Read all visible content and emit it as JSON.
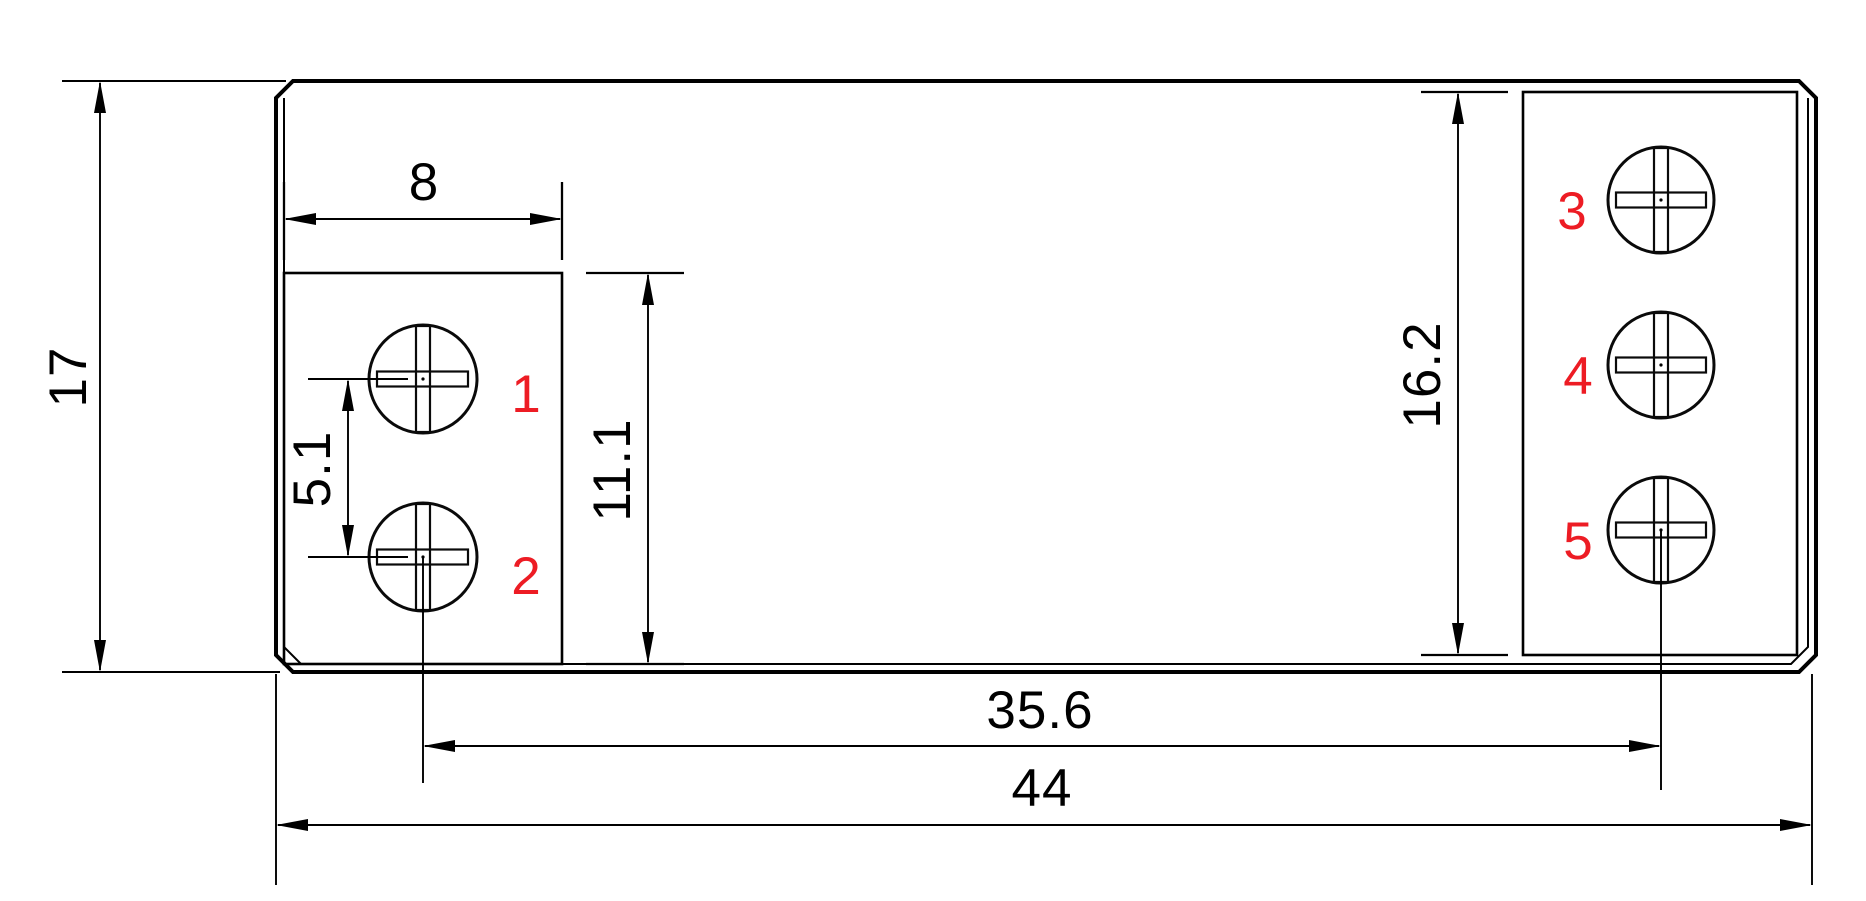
{
  "drawing": {
    "kind": "technical-dimension-drawing",
    "colors": {
      "background": "#ffffff",
      "line": "#000000",
      "terminal_label_red": "#ed1c24"
    },
    "dimensions": {
      "overall_height": "17",
      "left_block_width": "8",
      "left_screw_pitch": "5.1",
      "left_block_height": "11.1",
      "right_block_height": "16.2",
      "screw_span": "35.6",
      "overall_width": "44"
    },
    "terminal_labels": [
      "1",
      "2",
      "3",
      "4",
      "5"
    ]
  }
}
